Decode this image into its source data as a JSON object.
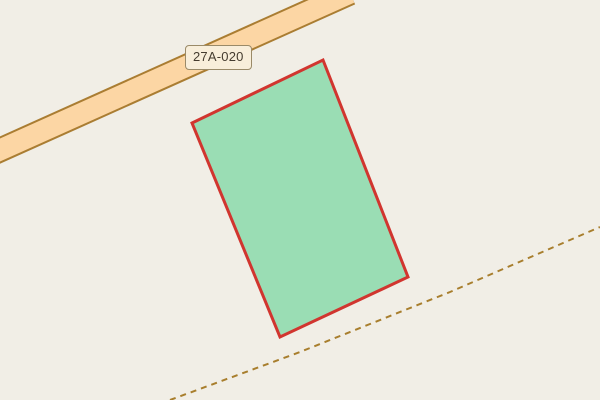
{
  "map": {
    "land_color": "#f1eee6"
  },
  "road": {
    "ref_label": "27A-020",
    "fill_color": "#fcd6a4",
    "casing_color": "#aa7d32",
    "centerline_points": "-20,159 350,-7",
    "casing_width": "25",
    "fill_width": "21",
    "label_bg": "#f8eeda",
    "label_border": "#9a8a68",
    "label_text_color": "#453c2f"
  },
  "parcel": {
    "points": "323,60 408,277 280,337 192,123",
    "fill_color": "#9addb4",
    "stroke_color": "#d1352f",
    "stroke_width": "3"
  },
  "track": {
    "points": "170,400 300,352 450,292 600,227",
    "color": "#a87e2d",
    "width": "2",
    "dash": "6 5"
  }
}
